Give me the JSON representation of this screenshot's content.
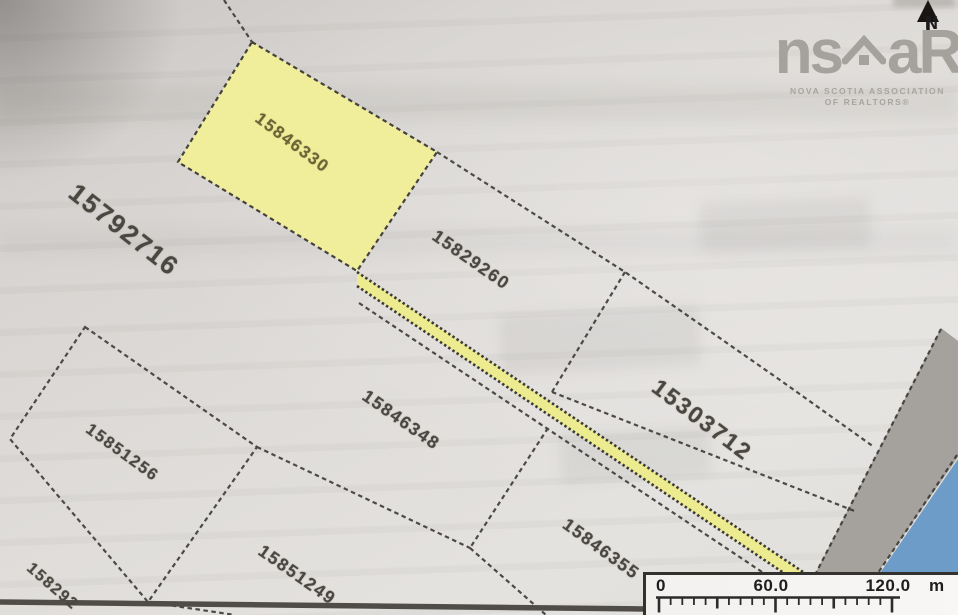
{
  "map": {
    "title_hint": "property parcel map",
    "parcels": [
      {
        "id": "15846330",
        "highlighted": true
      },
      {
        "id": "15792716",
        "highlighted": false
      },
      {
        "id": "15829260",
        "highlighted": false
      },
      {
        "id": "15303712",
        "highlighted": false
      },
      {
        "id": "15846348",
        "highlighted": false
      },
      {
        "id": "15851256",
        "highlighted": false
      },
      {
        "id": "15851249",
        "highlighted": false
      },
      {
        "id": "15846355",
        "highlighted": false
      },
      {
        "id": "158292",
        "highlighted": false,
        "partial": true
      }
    ],
    "colors": {
      "highlight_parcel_fill": "#f1ee9b",
      "road_strip_fill": "#eceb8f",
      "road_gray": "#a5a19c",
      "water_blue": "#6d9cc9",
      "boundary_line": "#3c3a36"
    }
  },
  "logo": {
    "brand_left": "ns",
    "brand_right": "aR",
    "subtitle1": "NOVA SCOTIA ASSOCIATION",
    "subtitle2": "OF REALTORS®",
    "house_icon": "house-roof-icon"
  },
  "north": {
    "label": "N"
  },
  "scale_bar": {
    "start": "0",
    "mid": "60.0",
    "end": "120.0",
    "unit": "m"
  }
}
